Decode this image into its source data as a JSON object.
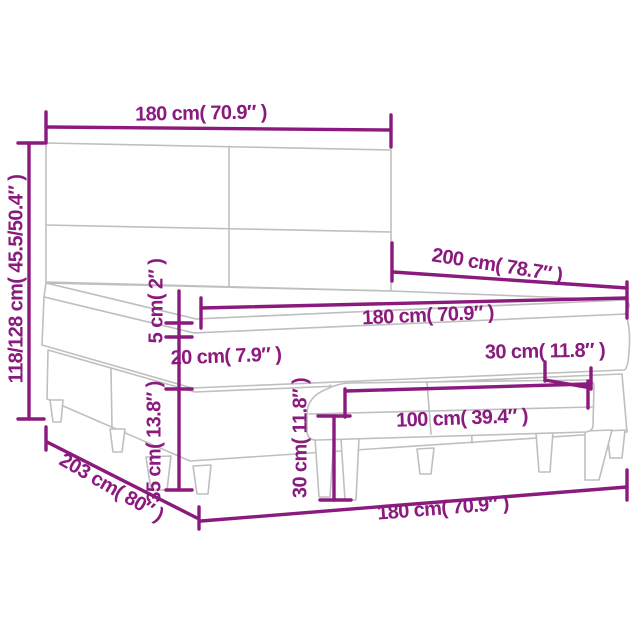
{
  "diagram_type": "product-dimension-diagram",
  "product": "box spring bed with headboard, mattress topper and bench",
  "colors": {
    "accent": "#8a1a7d",
    "furniture_line": "#bfbfbf",
    "background": "#ffffff"
  },
  "labels": {
    "headboard_width": {
      "text": "180 cm( 70.9″ )"
    },
    "total_height": {
      "text": "118/128 cm( 45.5/50.4″ )"
    },
    "bed_length": {
      "text": "200 cm( 78.7″ )"
    },
    "mattress_width": {
      "text": "180 cm( 70.9″ )"
    },
    "topper_height": {
      "text": "5 cm( 2″ )"
    },
    "mattress_height": {
      "text": "20 cm( 7.9″ )"
    },
    "base_height": {
      "text": "35 cm( 13.8″ )"
    },
    "floor_length": {
      "text": "203 cm( 80″ )"
    },
    "floor_width": {
      "text": "180 cm( 70.9″ )"
    },
    "bench_height": {
      "text": "30 cm( 11.8″ )"
    },
    "bench_length": {
      "text": "100 cm( 39.4″ )"
    },
    "bench_depth": {
      "text": "30 cm( 11.8″ )"
    }
  }
}
